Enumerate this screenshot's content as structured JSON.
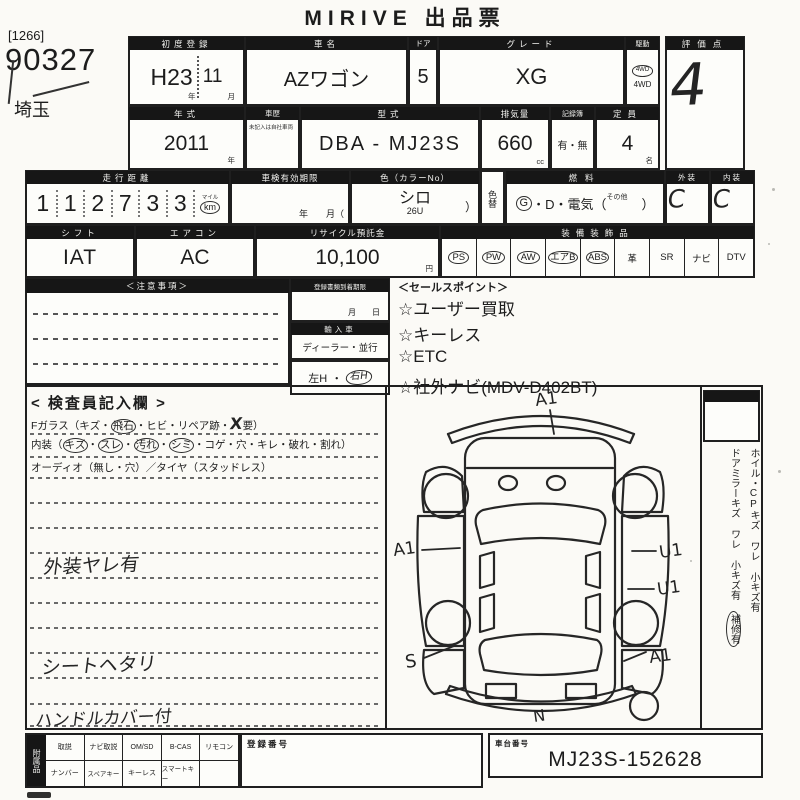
{
  "page": {
    "title": "MIRIVE 出品票",
    "lot_bracket": "[1266]",
    "lot_number": "90327",
    "prefecture": "埼玉"
  },
  "row1": {
    "first_reg": {
      "label": "初度登録",
      "year": "H23",
      "month": "11",
      "year_unit": "年",
      "month_unit": "月"
    },
    "car_name": {
      "label": "車名",
      "value": "AZワゴン"
    },
    "doors": {
      "label": "ドア",
      "value": "5"
    },
    "grade": {
      "label": "グレード",
      "value": "XG"
    },
    "drive": {
      "label": "駆動",
      "stamp": "4WD",
      "value": "4WD"
    },
    "score": {
      "label": "評価点",
      "value": "4"
    }
  },
  "row2": {
    "model_year": {
      "label": "年式",
      "value": "2011",
      "unit": "年"
    },
    "history": {
      "label": "車歴",
      "note": "未記入は自社車両"
    },
    "model_code": {
      "label": "型式",
      "value": "DBA - MJ23S"
    },
    "displacement": {
      "label": "排気量",
      "value": "660",
      "unit": "cc"
    },
    "record_book": {
      "label": "記録簿",
      "value": "有・無"
    },
    "capacity": {
      "label": "定員",
      "value": "4",
      "unit": "名"
    }
  },
  "row3": {
    "mileage": {
      "label": "走行距離",
      "digits": [
        "1",
        "1",
        "2",
        "7",
        "3",
        "3"
      ],
      "mile_label": "マイル",
      "unit": "km"
    },
    "inspection": {
      "label": "車検有効期限",
      "units": "年　　月（"
    },
    "color": {
      "label": "色（カラーNo）",
      "value": "シロ",
      "code": "26U",
      "close_paren": "）"
    },
    "color_change": {
      "label": "色替"
    },
    "fuel": {
      "label": "燃料",
      "g": "G",
      "rest": "・D・電気（",
      "other": "その他",
      "close": "）"
    },
    "exterior": {
      "label": "外装",
      "value": "C"
    },
    "interior": {
      "label": "内装",
      "value": "C"
    }
  },
  "row4": {
    "shift": {
      "label": "シフト",
      "value": "IAT"
    },
    "aircon": {
      "label": "エアコン",
      "value": "AC"
    },
    "recycle": {
      "label": "リサイクル預託金",
      "value": "10,100",
      "unit": "円"
    },
    "equipment": {
      "label": "装備装飾品",
      "items": [
        {
          "label": "PS",
          "circled": true
        },
        {
          "label": "PW",
          "circled": true
        },
        {
          "label": "AW",
          "circled": true
        },
        {
          "label": "エアB",
          "circled": true
        },
        {
          "label": "ABS",
          "circled": true
        },
        {
          "label": "革",
          "circled": false
        },
        {
          "label": "SR",
          "circled": false
        },
        {
          "label": "ナビ",
          "circled": false
        },
        {
          "label": "DTV",
          "circled": false
        }
      ]
    }
  },
  "middle": {
    "notice": {
      "label": "＜注意事項＞"
    },
    "arrival": {
      "label": "登録書類到着期限",
      "units": "月　　日"
    },
    "import_car": {
      "label": "輸入車",
      "value": "ディーラー・並行"
    },
    "handle": {
      "left": "左H",
      "dot": "・",
      "right": "右H"
    },
    "sales": {
      "label": "＜セールスポイント＞",
      "items": [
        "☆ユーザー買取",
        "☆キーレス",
        "☆ETC",
        "☆社外ナビ(MDV-D402BT)"
      ]
    }
  },
  "inspector": {
    "title": "< 検査員記入欄 >",
    "glass": {
      "p0": "Fガラス（キズ・",
      "p1": "飛石",
      "p2": "・ヒビ・リペア跡・",
      "x": "X",
      "p4": "要）"
    },
    "interior_line": {
      "p0": "内装（",
      "w1": "キズ",
      "d1": "・",
      "w2": "スレ",
      "d2": "・",
      "w3": "汚れ",
      "d3": "・",
      "w4": "シミ",
      "p5": "・コゲ・穴・キレ・破れ・割れ）"
    },
    "audio_line": "オーディオ（無し・穴）／タイヤ（スタッドレス）",
    "notes": [
      "外装ヤレ有",
      "シートヘタリ",
      "ハンドルカバー付"
    ]
  },
  "diagram": {
    "marks": {
      "front": "A1",
      "left": "A1",
      "left_rear": "S",
      "right_front": "U1",
      "right_mid": "U1",
      "right_rear": "A1",
      "rear": "N"
    }
  },
  "side": {
    "wheel_note": "ホイル・CPキズ ワレ 小キズ有",
    "mirror_note": "ドアミラーキズ ワレ 小キズ有",
    "repair_note": "補修有"
  },
  "bottom": {
    "acc_label": "附属品",
    "row1": [
      "取説",
      "ナビ取説",
      "OM/SD",
      "B-CAS",
      "リモコン"
    ],
    "row2": [
      "ナンバー",
      "スペアキー",
      "キーレス",
      "スマートキー",
      ""
    ],
    "reg_label": "登録番号",
    "chassis_label": "車台番号",
    "chassis_value": "MJ23S-152628"
  },
  "colors": {
    "ink": "#1c1c1c",
    "bar": "#161616",
    "paper": "#fbfaf6"
  }
}
